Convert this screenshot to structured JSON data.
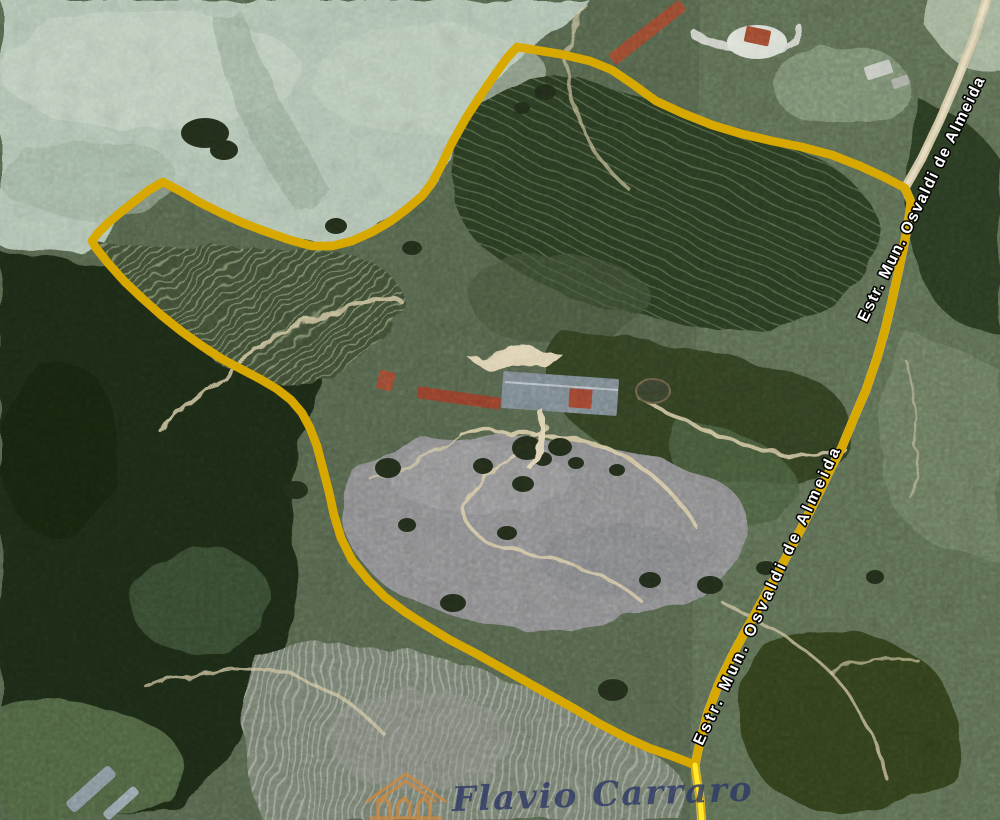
{
  "map": {
    "kind": "satellite-imagery",
    "boundary": {
      "description": "yellow property boundary outline",
      "color": "#ffe92a",
      "edge_color": "#d8a800"
    },
    "road": {
      "name": "Estr. Mun. Osvaldi de Almeida",
      "labels": {
        "upper": "Estr. Mun. Osvaldi de Almeida",
        "lower": "Estr. Mun. Osvaldi de Almeida"
      },
      "text_color": "#ffffff",
      "halo_color": "#000000",
      "surface_color": "#d8cba6"
    },
    "terrain": {
      "pale_pasture": "#b3c5b4",
      "dark_forest": "#1e2a16",
      "coffee_field": "#3f4e35",
      "cleared_gray_field": "#8e8e90",
      "trail": "#dccfa8"
    }
  },
  "watermark": {
    "text": "Flavio Carraro",
    "text_color": "#2f3a68",
    "icon": "house-logo-icon",
    "icon_color": "#d0893c"
  }
}
